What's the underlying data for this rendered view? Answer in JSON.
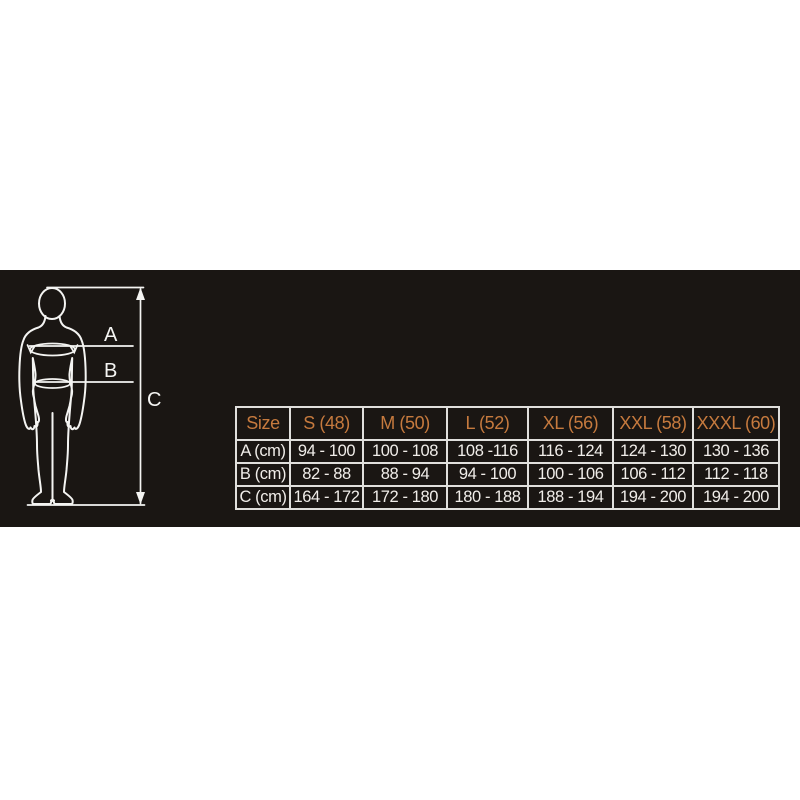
{
  "theme": {
    "accent": "#c67a3e",
    "table-border": "#e0dfdc",
    "table-text": "#f0ede9",
    "band-bg": "#1a1613",
    "figure-line": "#f4f4f2",
    "page-bg": "#ffffff"
  },
  "figure": {
    "label_a": "A",
    "label_b": "B",
    "label_c": "C"
  },
  "size_table": {
    "columns": [
      "Size",
      "S (48)",
      "M (50)",
      "L (52)",
      "XL (56)",
      "XXL (58)",
      "XXXL (60)"
    ],
    "rows": [
      {
        "label": "A (cm)",
        "values": [
          "94 - 100",
          "100 - 108",
          "108 -116",
          "116 - 124",
          "124 - 130",
          "130 - 136"
        ]
      },
      {
        "label": "B (cm)",
        "values": [
          "82 - 88",
          "88 - 94",
          "94 - 100",
          "100 - 106",
          "106 - 112",
          "112 - 118"
        ]
      },
      {
        "label": "C (cm)",
        "values": [
          "164 - 172",
          "172 - 180",
          "180 - 188",
          "188 - 194",
          "194 - 200",
          "194 - 200"
        ]
      }
    ]
  }
}
